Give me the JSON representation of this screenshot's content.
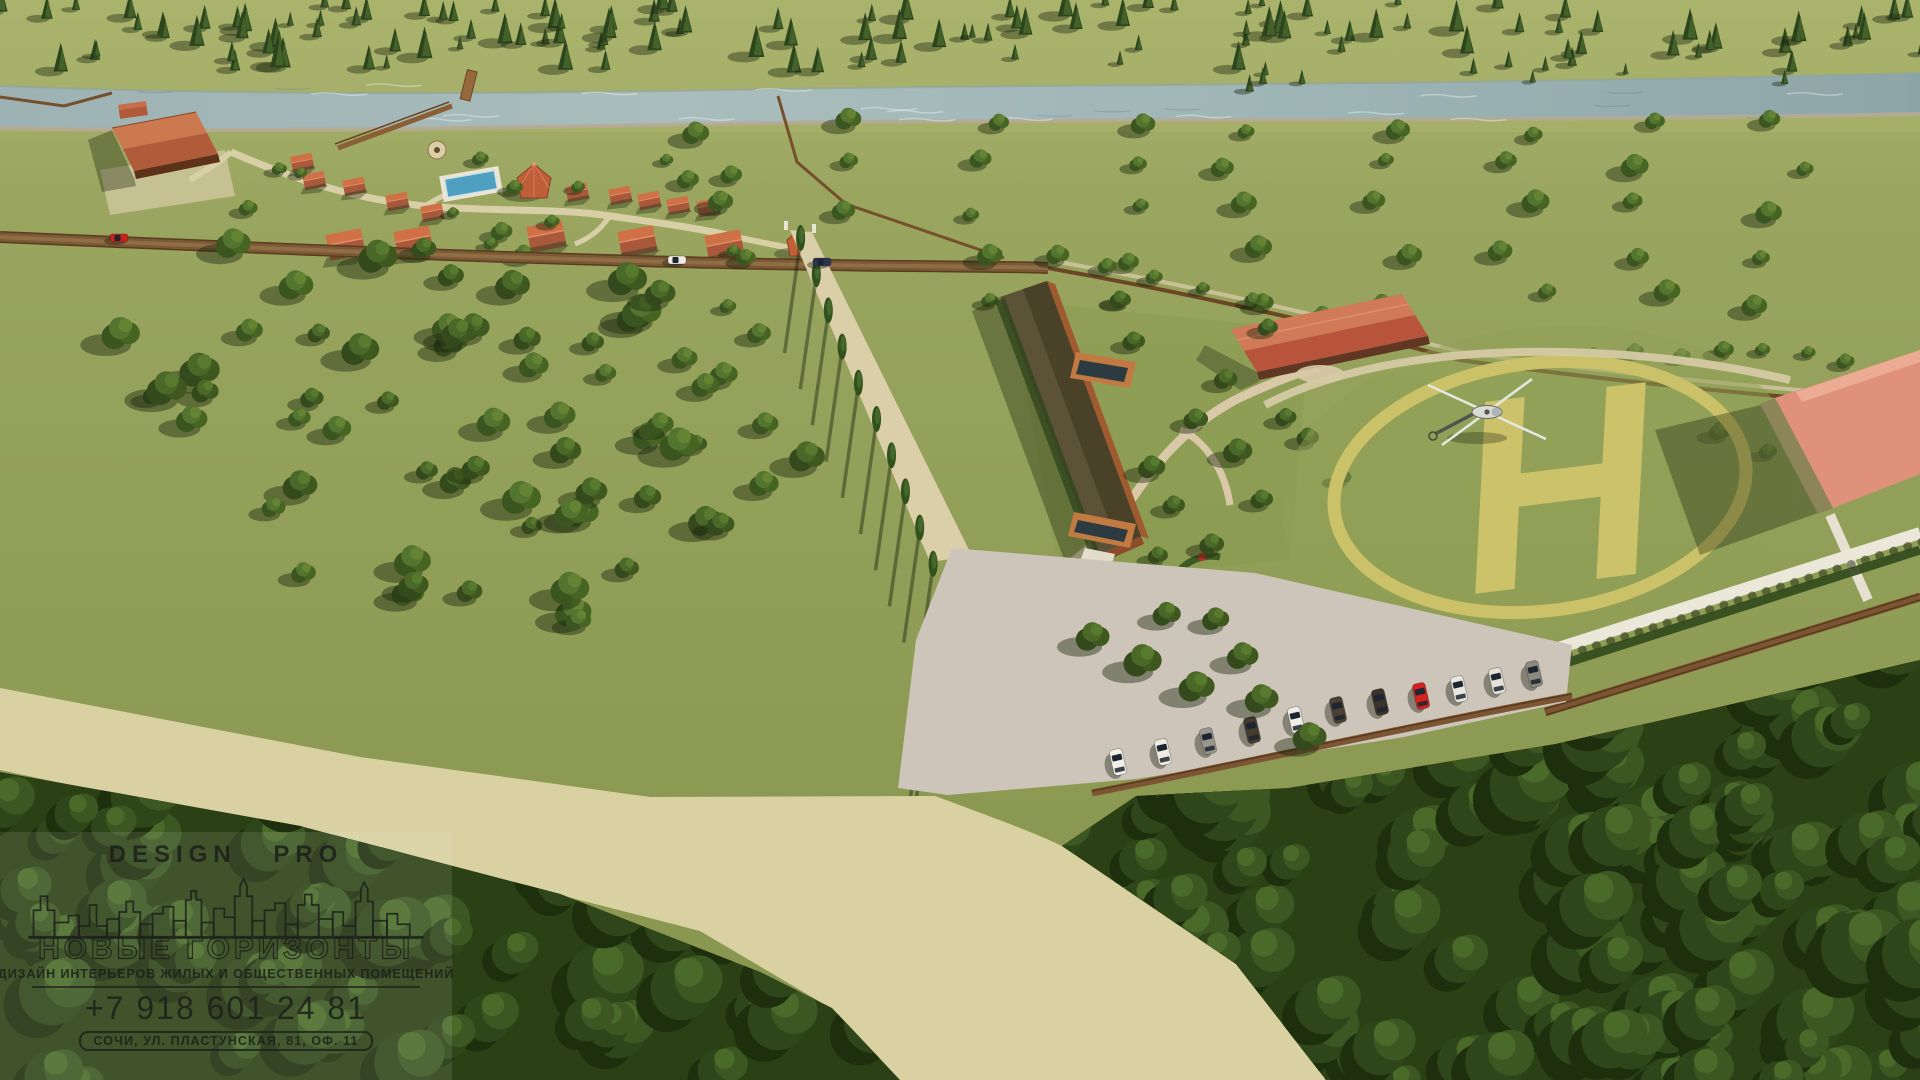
{
  "branding": {
    "studio_name": "DESIGN PRO",
    "wordmark": "НОВЫЕ ГОРИЗОНТЫ",
    "tagline": "ДИЗАЙН ИНТЕРЬЕРОВ ЖИЛЫХ И ОБЩЕСТВЕННЫХ ПОМЕЩЕНИЙ",
    "phone": "+7 918 601 24 81",
    "address": "СОЧИ, УЛ. ПЛАСТУНСКАЯ, 81, ОФ. 11"
  },
  "scene": {
    "type": "aerial architectural site visualization",
    "helipad_marking": "H",
    "colors": {
      "grass": "#93a059",
      "forest": "#2b4015",
      "river": "#a3b8ba",
      "road_tan": "#d9d1a1",
      "parking_concrete": "#cdc5b9",
      "roof_terracotta": "#c05a3e",
      "roof_salmon": "#e0917b",
      "helipad_yellow": "#cbc168",
      "fence_brown": "#7b5836",
      "car_red": "#d3231e"
    }
  }
}
